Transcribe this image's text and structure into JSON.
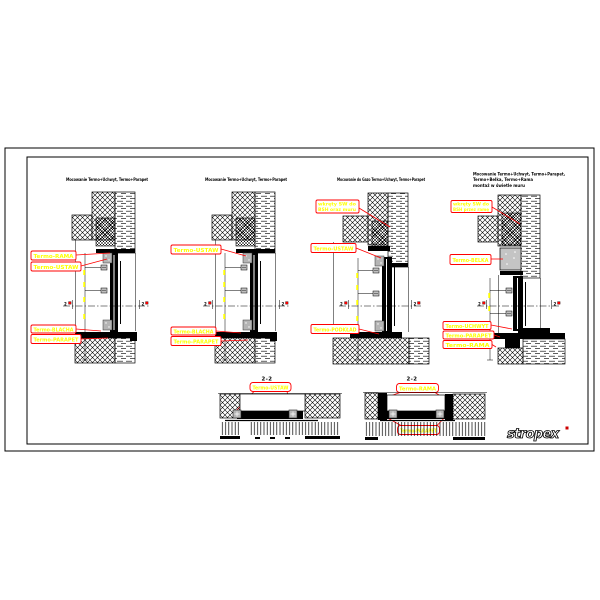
{
  "section_marker": "2",
  "logo": {
    "text": "stropex",
    "mark_color": "#cc0000"
  },
  "colors": {
    "callout": "#ff0000",
    "label_text": "#ffff00",
    "ink": "#000000"
  },
  "details": [
    {
      "title_lines": [
        "Mocowanie Termo+Uchwyt, Termo+Parapet"
      ],
      "labels": [
        "Termo-RAMA",
        "Termo-USTAW",
        "Termo-BLACHA",
        "Termo-PARAPET"
      ]
    },
    {
      "title_lines": [
        "Mocowanie Termo+Uchwyt, Termo+Parapet"
      ],
      "labels": [
        "Termo-USTAW",
        "Termo-BLACHA",
        "Termo-PARAPET"
      ]
    },
    {
      "title_lines": [
        "Mocowanie do Gazo Termo+Uchwyt, Termo+Parapet"
      ],
      "labels": [
        "wkręty SW do",
        "BSH oraz muru",
        "Termo-USTAW",
        "Termo-PODKŁAD"
      ]
    },
    {
      "title_lines": [
        "Mocowanie Termo+Uchwyt, Termo+Parapet,",
        "Termo+Belka, Termo+Rama",
        "montaż w świetle muru"
      ],
      "labels": [
        "wkręty SW do",
        "BSH przez ramę",
        "Termo-BELKA",
        "Termo-UCHWYT",
        "Termo-PARAPET",
        "Termo-RAMA"
      ]
    }
  ],
  "sections": [
    {
      "title": "2-2",
      "labels": [
        "Termo-USTAW"
      ]
    },
    {
      "title": "2-2",
      "labels": [
        "Termo-RAMA",
        "Termo-PARAPET"
      ]
    }
  ]
}
